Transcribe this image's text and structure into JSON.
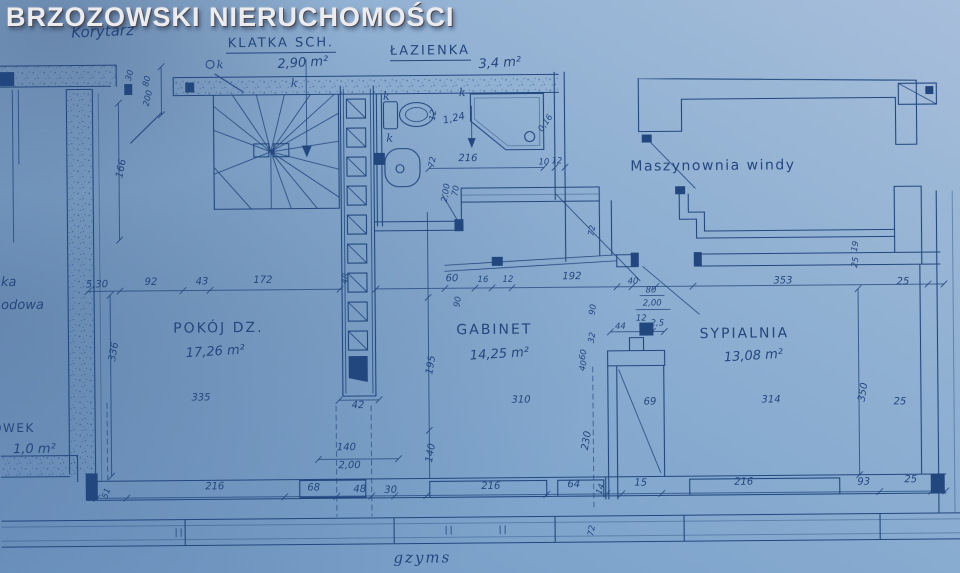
{
  "watermark": "BRZOZOWSKI NIERUCHOMOŚCI",
  "plan": {
    "colors": {
      "paper": "#84a9cf",
      "ink": "#24477e",
      "watermark": "#ececee"
    },
    "rooms": [
      {
        "id": "korytarz",
        "label": "Korytarz",
        "area": ""
      },
      {
        "id": "klatka-schodowa",
        "label": "KLATKA SCH.",
        "area": "2,90 m²"
      },
      {
        "id": "lazienka",
        "label": "ŁAZIENKA",
        "area": "3,4 m²"
      },
      {
        "id": "maszynownia-windy",
        "label": "Maszynownia windy",
        "area": ""
      },
      {
        "id": "pokoj-dzienny",
        "label": "POKÓJ DZ.",
        "area": "17,26 m²"
      },
      {
        "id": "gabinet",
        "label": "GABINET",
        "area": "14,25 m²"
      },
      {
        "id": "sypialnia",
        "label": "SYPIALNIA",
        "area": "13,08 m²"
      },
      {
        "id": "schowek",
        "label": "CHOWEK",
        "area": "1,0 m²"
      }
    ],
    "annotations": [
      {
        "id": "gzyms",
        "text": "gzyms"
      },
      {
        "id": "left-fragment-1",
        "text": "ka"
      },
      {
        "id": "left-fragment-2",
        "text": "odowa"
      }
    ],
    "vent_label": "k",
    "vent_markers": [
      {
        "x": 222,
        "y": 66
      },
      {
        "x": 296,
        "y": 85
      },
      {
        "x": 388,
        "y": 99
      },
      {
        "x": 464,
        "y": 96
      },
      {
        "x": 391,
        "y": 141
      }
    ],
    "dimensions": [
      {
        "t": "5,30",
        "x": 97,
        "y": 284
      },
      {
        "t": "92",
        "x": 151,
        "y": 282
      },
      {
        "t": "43",
        "x": 202,
        "y": 282
      },
      {
        "t": "172",
        "x": 263,
        "y": 281
      },
      {
        "t": "48",
        "x": 348,
        "y": 278,
        "r": -80,
        "s": 1
      },
      {
        "t": "60",
        "x": 452,
        "y": 281
      },
      {
        "t": "16",
        "x": 483,
        "y": 282,
        "s": 1
      },
      {
        "t": "12",
        "x": 508,
        "y": 282,
        "s": 1
      },
      {
        "t": "192",
        "x": 572,
        "y": 280
      },
      {
        "t": "40",
        "x": 633,
        "y": 285,
        "s": 1
      },
      {
        "t": "80",
        "x": 651,
        "y": 294,
        "s": 1
      },
      {
        "t": "2,00",
        "x": 652,
        "y": 307,
        "s": 1
      },
      {
        "t": "90",
        "x": 595,
        "y": 311,
        "r": -80,
        "s": 1
      },
      {
        "t": "353",
        "x": 783,
        "y": 286
      },
      {
        "t": "25",
        "x": 903,
        "y": 288
      },
      {
        "t": "51",
        "x": 107,
        "y": 491,
        "r": -70,
        "s": 1
      },
      {
        "t": "216",
        "x": 213,
        "y": 487
      },
      {
        "t": "68",
        "x": 312,
        "y": 489
      },
      {
        "t": "48",
        "x": 358,
        "y": 491
      },
      {
        "t": "30",
        "x": 389,
        "y": 492
      },
      {
        "t": "216",
        "x": 489,
        "y": 489
      },
      {
        "t": "64",
        "x": 572,
        "y": 488
      },
      {
        "t": "14",
        "x": 601,
        "y": 491,
        "r": -70,
        "s": 1
      },
      {
        "t": "15",
        "x": 639,
        "y": 487
      },
      {
        "t": "216",
        "x": 742,
        "y": 487
      },
      {
        "t": "93",
        "x": 862,
        "y": 488
      },
      {
        "t": "25",
        "x": 909,
        "y": 486
      },
      {
        "t": "30",
        "x": 134,
        "y": 73,
        "r": -75,
        "s": 1
      },
      {
        "t": "80",
        "x": 151,
        "y": 79,
        "r": -75,
        "s": 1
      },
      {
        "t": "200",
        "x": 152,
        "y": 96,
        "r": -75,
        "s": 1
      },
      {
        "t": "166",
        "x": 125,
        "y": 166,
        "r": -78
      },
      {
        "t": "336",
        "x": 116,
        "y": 349,
        "r": -80
      },
      {
        "t": "1,24",
        "x": 456,
        "y": 121,
        "r": -12
      },
      {
        "t": "216",
        "x": 469,
        "y": 161
      },
      {
        "t": "0,16",
        "x": 549,
        "y": 125,
        "r": -55,
        "s": 1
      },
      {
        "t": "10",
        "x": 545,
        "y": 165,
        "s": 1
      },
      {
        "t": "12",
        "x": 558,
        "y": 164,
        "s": 1
      },
      {
        "t": "12",
        "x": 437,
        "y": 115,
        "r": -80,
        "s": 1
      },
      {
        "t": "72",
        "x": 436,
        "y": 162,
        "r": -80,
        "s": 1
      },
      {
        "t": "2,00",
        "x": 449,
        "y": 193,
        "r": -80,
        "s": 1
      },
      {
        "t": "70",
        "x": 459,
        "y": 191,
        "r": -80,
        "s": 1
      },
      {
        "t": "72",
        "x": 595,
        "y": 232,
        "r": -80,
        "s": 1
      },
      {
        "t": "90",
        "x": 460,
        "y": 302,
        "r": -80,
        "s": 1
      },
      {
        "t": "44",
        "x": 620,
        "y": 330,
        "s": 1
      },
      {
        "t": "12",
        "x": 641,
        "y": 322,
        "s": 1
      },
      {
        "t": "2,5",
        "x": 657,
        "y": 327,
        "s": 1
      },
      {
        "t": "32",
        "x": 594,
        "y": 339,
        "r": -80,
        "s": 1
      },
      {
        "t": "60",
        "x": 585,
        "y": 356,
        "r": -80,
        "s": 1
      },
      {
        "t": "40",
        "x": 585,
        "y": 367,
        "r": -80,
        "s": 1
      },
      {
        "t": "69",
        "x": 649,
        "y": 406
      },
      {
        "t": "230",
        "x": 588,
        "y": 442,
        "r": -80
      },
      {
        "t": "310",
        "x": 520,
        "y": 403
      },
      {
        "t": "335",
        "x": 200,
        "y": 398
      },
      {
        "t": "314",
        "x": 770,
        "y": 405
      },
      {
        "t": "42",
        "x": 357,
        "y": 407
      },
      {
        "t": "195",
        "x": 433,
        "y": 365,
        "r": -80
      },
      {
        "t": "140",
        "x": 432,
        "y": 453,
        "r": -80
      },
      {
        "t": "140",
        "x": 345,
        "y": 449
      },
      {
        "t": "2,00",
        "x": 348,
        "y": 467
      },
      {
        "t": "350",
        "x": 865,
        "y": 396,
        "r": -80
      },
      {
        "t": "25",
        "x": 899,
        "y": 408
      },
      {
        "t": "19",
        "x": 858,
        "y": 250,
        "r": -80,
        "s": 1
      },
      {
        "t": "25",
        "x": 858,
        "y": 266,
        "r": -80,
        "s": 1
      },
      {
        "t": "72",
        "x": 592,
        "y": 532,
        "r": -80,
        "s": 1
      }
    ]
  }
}
